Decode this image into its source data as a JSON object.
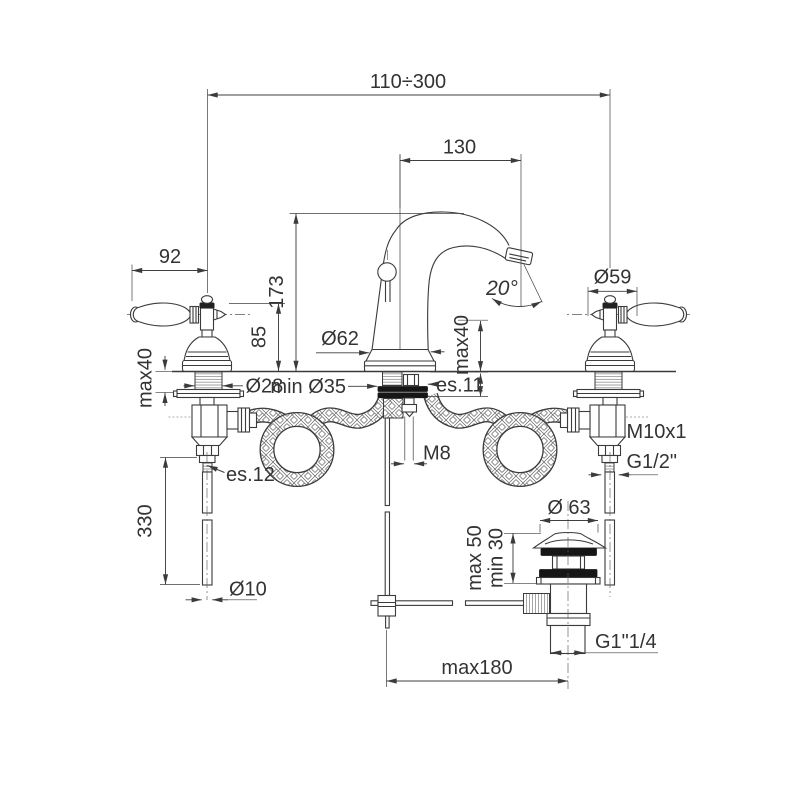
{
  "diagram": {
    "type": "technical-drawing",
    "subject": "3-hole basin mixer faucet with lever handles, swan-neck spout, flexible supply hoses and pop-up waste — dimensional drawing",
    "units": "mm",
    "colors": {
      "line": "#3b3b3b",
      "gasket": "#161616",
      "background": "#ffffff",
      "text": "#333333"
    },
    "labels": {
      "total_reach": "110÷300",
      "spout_reach": "130",
      "handle_length": "92",
      "spout_height": "173",
      "handle_height": "85",
      "handle_max_deck": "max40",
      "spout_base_dia": "Ø62",
      "shank_dia": "Ø28",
      "min_hole_dia": "min Ø35",
      "lock_hex": "es.11",
      "spout_max_deck": "max40",
      "spray_angle": "20°",
      "handle_base_dia": "Ø59",
      "valve_thread": "M10x1",
      "hose_thread": "G1/2\"",
      "rod_thread": "M8",
      "supply_hex": "es.12",
      "supply_pipe_length": "330",
      "supply_pipe_dia": "Ø10",
      "waste_plug_dia": "Ø 63",
      "waste_deck_max": "max 50",
      "waste_deck_min": "min 30",
      "waste_outlet_thread": "G1\"1/4",
      "rod_offset_max": "max180"
    }
  }
}
